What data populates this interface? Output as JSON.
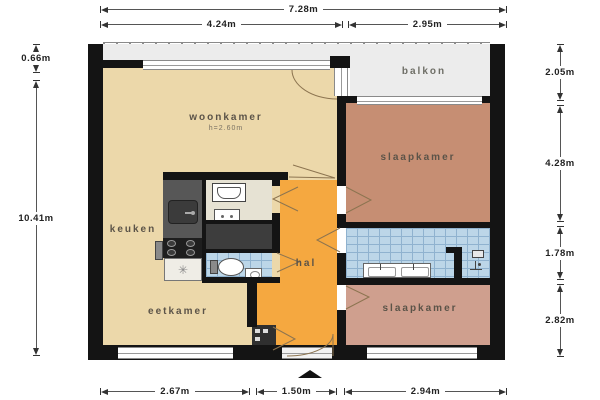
{
  "plan": {
    "rooms": {
      "woonkamer": {
        "label": "woonkamer",
        "note": "h=2.60m",
        "color": "#ecd8aa"
      },
      "keuken": {
        "label": "keuken",
        "color": "#ecd8aa"
      },
      "eetkamer": {
        "label": "eetkamer",
        "color": "#ecd8aa"
      },
      "hal": {
        "label": "hal",
        "color": "#f5a840"
      },
      "balkon": {
        "label": "balkon",
        "color": "#ececec"
      },
      "slaapkamer_1": {
        "label": "slaapkamer",
        "color": "#c68e73"
      },
      "slaapkamer_2": {
        "label": "slaapkamer",
        "color": "#cf9f8e"
      }
    },
    "fixtures": {
      "dishwasher": {
        "symbol": "✳"
      }
    },
    "colors": {
      "wall": "#141414",
      "bathroom_tile": "#bcd6e8",
      "kitchen_counter": "#575757",
      "closet": "#3d3d3d",
      "door_swing_line": "#8c7450"
    }
  },
  "dimensions": {
    "top": [
      {
        "label": "7.28m"
      },
      {
        "label": "4.24m"
      },
      {
        "label": "2.95m"
      }
    ],
    "left": [
      {
        "label": "0.66m"
      },
      {
        "label": "10.41m"
      }
    ],
    "right": [
      {
        "label": "2.05m"
      },
      {
        "label": "4.28m"
      },
      {
        "label": "1.78m"
      },
      {
        "label": "2.82m"
      }
    ],
    "bottom": [
      {
        "label": "2.67m"
      },
      {
        "label": "1.50m"
      },
      {
        "label": "2.94m"
      }
    ]
  },
  "compass": {
    "name": "north-arrow"
  }
}
